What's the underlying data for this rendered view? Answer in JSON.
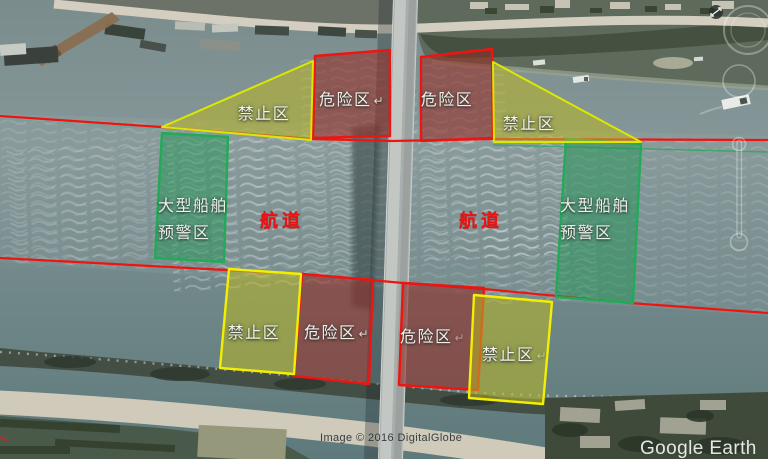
{
  "branding": {
    "watermark": "Google Earth",
    "copyright": "Image © 2016 DigitalGlobe"
  },
  "legend_colors": {
    "danger_zone_border": "#ee1511",
    "danger_zone_fill": "rgba(150,45,38,0.58)",
    "prohibited_zone_border": "#f2ef00",
    "prohibited_zone_fill": "rgba(185,183,35,0.55)",
    "warning_zone_border": "#21aa57",
    "warning_zone_fill": "rgba(25,150,80,0.45)",
    "channel_line": "#ee1511",
    "channel_text": "#e81313"
  },
  "labels": [
    {
      "id": "prohibited-top-left",
      "text": "禁止区"
    },
    {
      "id": "danger-top-left",
      "text": "危险区",
      "mark": "↵"
    },
    {
      "id": "danger-top-right",
      "text": "危险区"
    },
    {
      "id": "prohibited-top-right",
      "text": "禁止区"
    },
    {
      "id": "warning-left",
      "line1": "大型船舶",
      "line2": "预警区"
    },
    {
      "id": "warning-right",
      "line1": "大型船舶",
      "line2": "预警区"
    },
    {
      "id": "channel-left",
      "text": "航道"
    },
    {
      "id": "channel-right",
      "text": "航道"
    },
    {
      "id": "prohibited-bottom-left",
      "text": "禁止区"
    },
    {
      "id": "danger-bottom-left",
      "text": "危险区",
      "mark": "↵"
    },
    {
      "id": "danger-bottom-right",
      "text": "危险区",
      "mark": "↵"
    },
    {
      "id": "prohibited-bottom-right",
      "text": "禁止区",
      "mark": "↵"
    }
  ]
}
